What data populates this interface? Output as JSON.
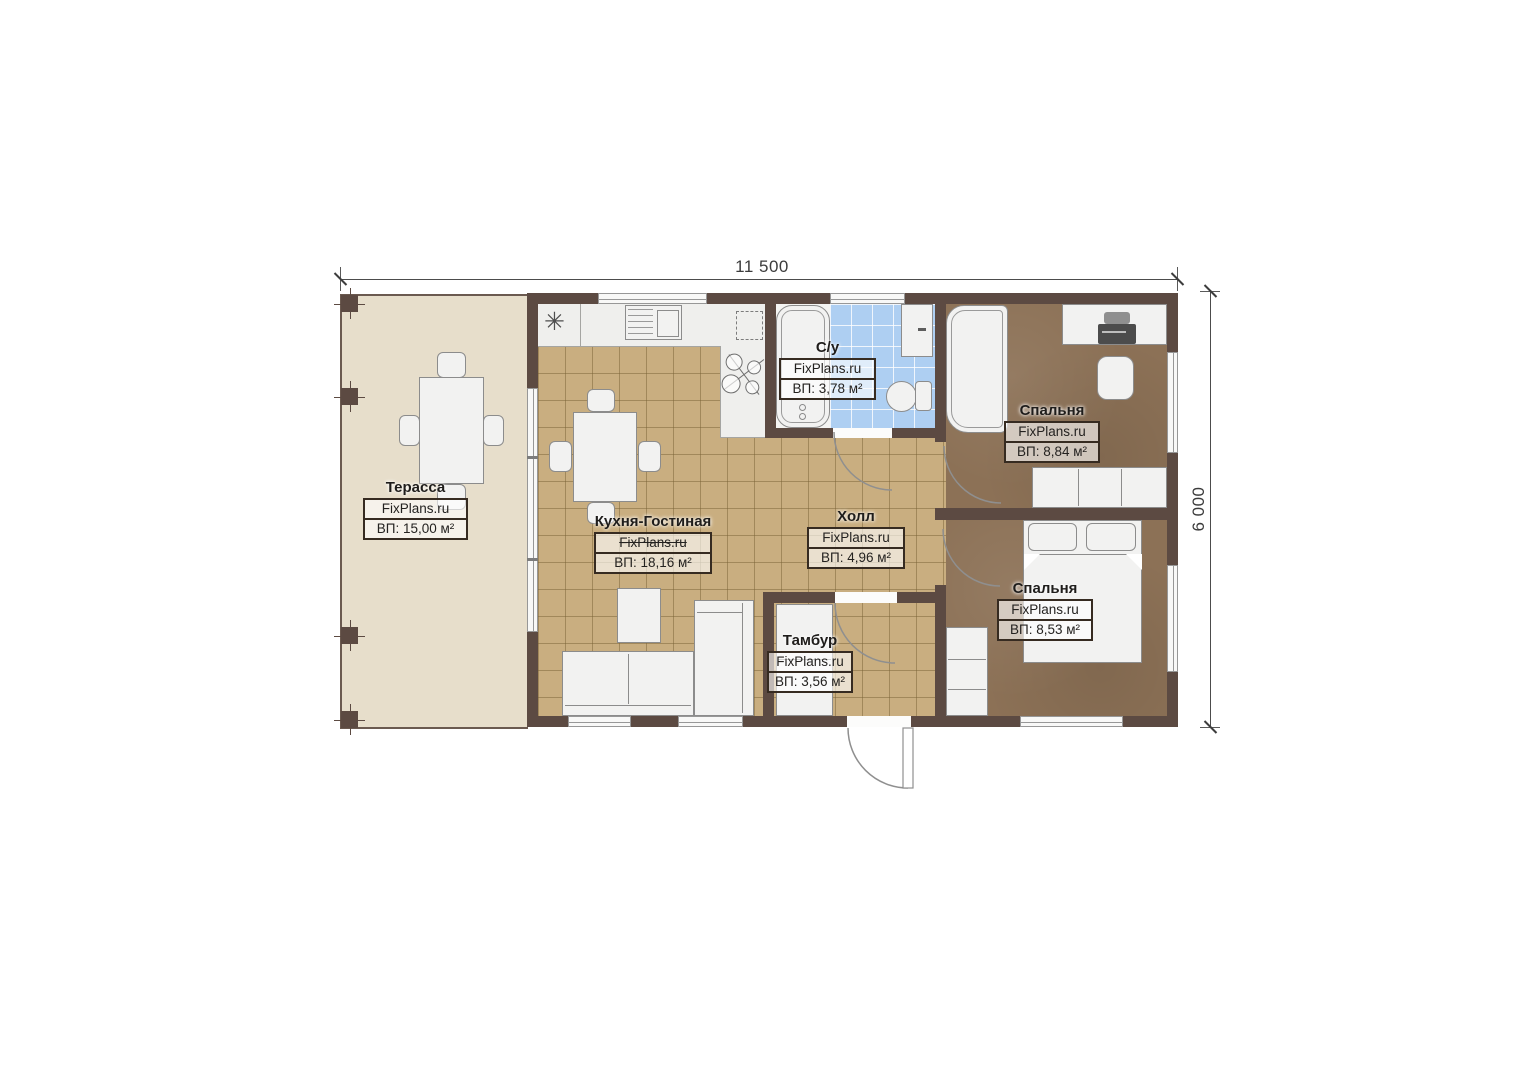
{
  "dimensions": {
    "width": "11 500",
    "height": "6 000"
  },
  "rooms": {
    "terrace": {
      "name": "Терасса",
      "brand": "FixPlans.ru",
      "area": "ВП: 15,00 м²"
    },
    "kitchen_living": {
      "name": "Кухня-Гостиная",
      "brand": "FixPlans.ru",
      "area": "ВП: 18,16 м²"
    },
    "bathroom": {
      "name": "С/у",
      "brand": "FixPlans.ru",
      "area": "ВП: 3,78 м²"
    },
    "hall": {
      "name": "Холл",
      "brand": "FixPlans.ru",
      "area": "ВП: 4,96 м²"
    },
    "bedroom_top": {
      "name": "Спальня",
      "brand": "FixPlans.ru",
      "area": "ВП: 8,84 м²"
    },
    "bedroom_bottom": {
      "name": "Спальня",
      "brand": "FixPlans.ru",
      "area": "ВП: 8,53 м²"
    },
    "vestibule": {
      "name": "Тамбур",
      "brand": "FixPlans.ru",
      "area": "ВП: 3,56 м²"
    }
  },
  "symbols": {
    "kitchen_vent": "✳"
  },
  "colors": {
    "wall": "#5c4a42",
    "floor_tile": "#c9ae80",
    "bedroom_floor": "#8c7156",
    "bathroom_tile": "#aecff2",
    "terrace_floor": "#e7decb",
    "furniture": "#f2f2f1"
  }
}
